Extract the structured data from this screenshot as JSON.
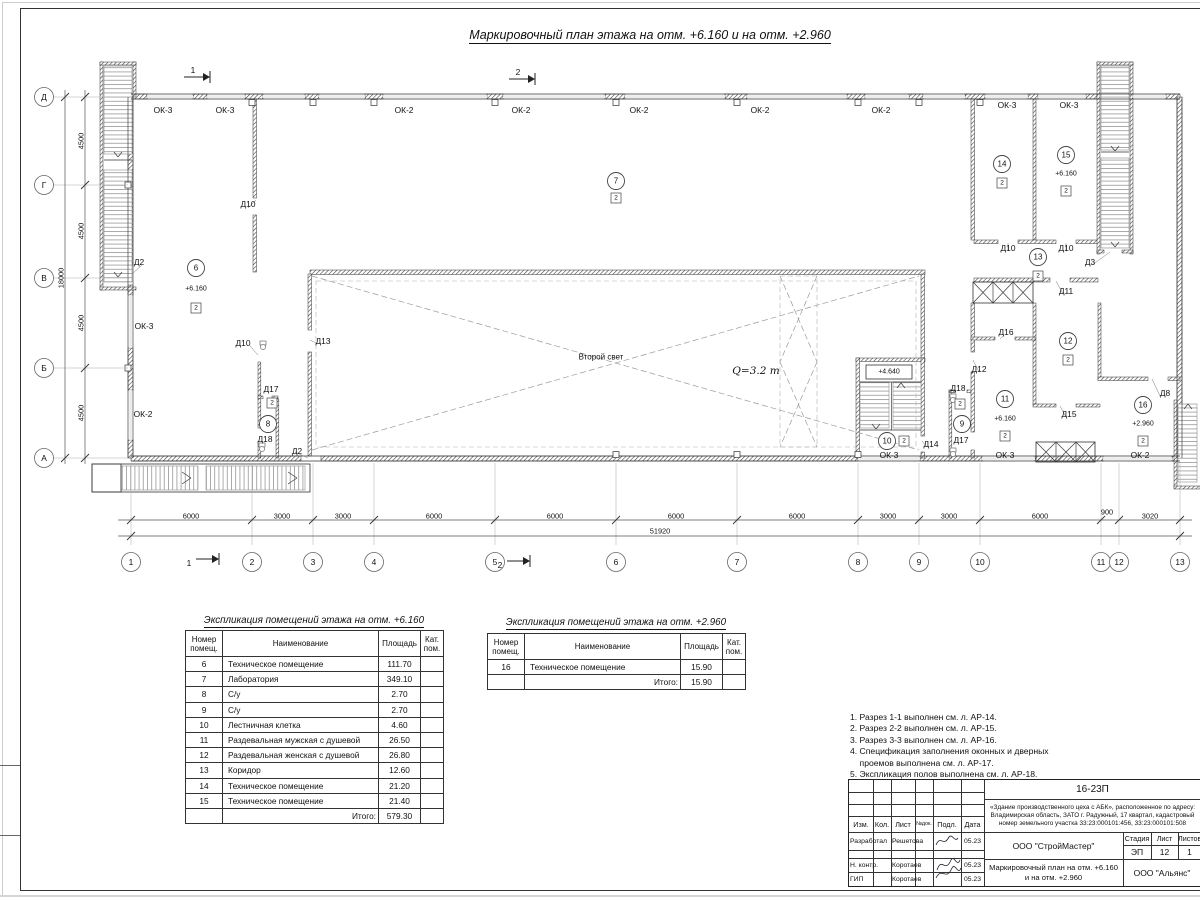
{
  "sheet": {
    "title": "Маркировочный план этажа на отм. +6.160 и на отм. +2.960",
    "second_light": "Второй свет",
    "crane_capacity": "Q=3.2 т",
    "stair_landing_elevation": "+4.640"
  },
  "plan": {
    "axis_numbers": [
      "1",
      "2",
      "3",
      "4",
      "5",
      "6",
      "7",
      "8",
      "9",
      "10",
      "11",
      "12",
      "13"
    ],
    "axis_letters": [
      "Д",
      "Г",
      "В",
      "Б",
      "А"
    ],
    "dims_horizontal": [
      "6000",
      "3000",
      "3000",
      "6000",
      "6000",
      "6000",
      "6000",
      "3000",
      "3000",
      "6000",
      "900",
      "3020"
    ],
    "dim_total_horizontal": "51920",
    "dims_vertical": [
      "4500",
      "4500",
      "4500",
      "4500"
    ],
    "dim_total_vertical": "18000",
    "section_marks": [
      "1",
      "2",
      "1",
      "2"
    ],
    "window_labels": [
      "ОК-3",
      "ОК-3",
      "ОК-2",
      "ОК-2",
      "ОК-2",
      "ОК-2",
      "ОК-2",
      "ОК-3",
      "ОК-3",
      "ОК-3",
      "ОК-2",
      "ОК-3",
      "ОК-3",
      "ОК-2"
    ],
    "door_labels": [
      "Д2",
      "Д10",
      "Д10",
      "Д13",
      "Д17",
      "Д18",
      "Д2",
      "Д14",
      "Д10",
      "Д10",
      "Д3",
      "Д11",
      "Д16",
      "Д12",
      "Д18",
      "Д17",
      "Д15",
      "Д8"
    ],
    "rooms": [
      {
        "number": "6",
        "elevation": "+6.160",
        "category": "2"
      },
      {
        "number": "7",
        "elevation": "",
        "category": "2"
      },
      {
        "number": "8",
        "elevation": "",
        "category": "2"
      },
      {
        "number": "9",
        "elevation": "",
        "category": "2"
      },
      {
        "number": "10",
        "elevation": "",
        "category": "2"
      },
      {
        "number": "11",
        "elevation": "+6.160",
        "category": "2"
      },
      {
        "number": "12",
        "elevation": "",
        "category": "2"
      },
      {
        "number": "13",
        "elevation": "",
        "category": "2"
      },
      {
        "number": "14",
        "elevation": "",
        "category": "2"
      },
      {
        "number": "15",
        "elevation": "+6.160",
        "category": "2"
      },
      {
        "number": "16",
        "elevation": "+2.960",
        "category": "2"
      }
    ]
  },
  "schedules": [
    {
      "title": "Экспликация помещений этажа на отм. +6.160",
      "headers": [
        "Номер\nпомещ.",
        "Наименование",
        "Площадь",
        "Кат.\nпом."
      ],
      "rows": [
        [
          "6",
          "Техническое помещение",
          "111.70",
          ""
        ],
        [
          "7",
          "Лаборатория",
          "349.10",
          ""
        ],
        [
          "8",
          "С/у",
          "2.70",
          ""
        ],
        [
          "9",
          "С/у",
          "2.70",
          ""
        ],
        [
          "10",
          "Лестничная клетка",
          "4.60",
          ""
        ],
        [
          "11",
          "Раздевальная мужская с душевой",
          "26.50",
          ""
        ],
        [
          "12",
          "Раздевальная женская с душевой",
          "26.80",
          ""
        ],
        [
          "13",
          "Коридор",
          "12.60",
          ""
        ],
        [
          "14",
          "Техническое помещение",
          "21.20",
          ""
        ],
        [
          "15",
          "Техническое помещение",
          "21.40",
          ""
        ]
      ],
      "total_label": "Итого:",
      "total": "579.30"
    },
    {
      "title": "Экспликация помещений этажа на отм. +2.960",
      "headers": [
        "Номер\nпомещ.",
        "Наименование",
        "Площадь",
        "Кат.\nпом."
      ],
      "rows": [
        [
          "16",
          "Техническое помещение",
          "15.90",
          ""
        ]
      ],
      "total_label": "Итого:",
      "total": "15.90"
    }
  ],
  "notes": [
    "1. Разрез 1-1 выполнен см. л. АР-14.",
    "2. Разрез 2-2 выполнен см. л. АР-15.",
    "3. Разрез 3-3 выполнен см. л. АР-16.",
    "4. Спецификация заполнения оконных и дверных",
    "    проемов выполнена см. л. АР-17.",
    "5. Экспликация полов выполнена см. л. АР-18."
  ],
  "title_block": {
    "doc_number": "16-23П",
    "description": "«Здание производственного цеха с АБК», расположенное по адресу: Владимирская область, ЗАТО г. Радужный, 17 квартал, кадастровый номер земельного участка 33:23:000101:456, 33:23:000101:508",
    "col_headers": [
      "Изм.",
      "Кол.",
      "Лист",
      "№док.",
      "Подл.",
      "Дата"
    ],
    "sign_rows": [
      {
        "role": "Разработал",
        "name": "Решетова",
        "date": "05.23"
      },
      {
        "role": "Н. контр.",
        "name": "Коротаев",
        "date": "05.23"
      },
      {
        "role": "ГИП",
        "name": "Коротаев",
        "date": "05.23"
      }
    ],
    "organization": "ООО \"СтройМастер\"",
    "stage_label": "Стадия",
    "sheet_label": "Лист",
    "sheets_label": "Листов",
    "stage": "ЭП",
    "sheet_number": "12",
    "sheets_total": "1",
    "drawing_title": "Маркировочный план на отм. +6.160 и на отм. +2.960",
    "client": "ООО \"Альянс\""
  }
}
